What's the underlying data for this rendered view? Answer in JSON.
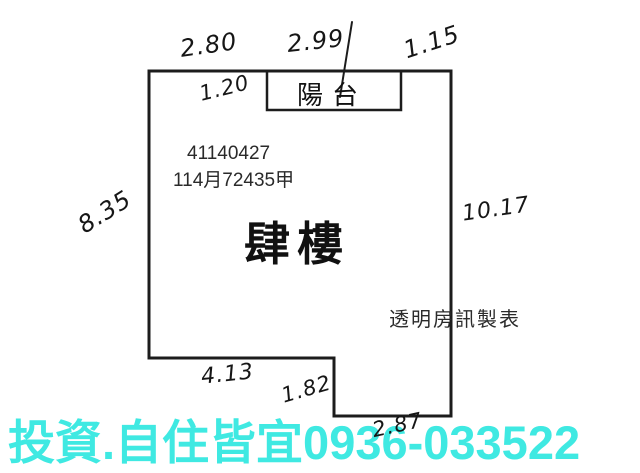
{
  "colors": {
    "background": "#ffffff",
    "outline": "#1c1c1c",
    "printed_text": "#2a2a2a",
    "handwriting": "#161616",
    "banner_text": "#3fe9e2"
  },
  "floorplan": {
    "balcony_label": "陽台",
    "serial_number": "41140427",
    "registration_number": "114月72435甲",
    "floor_label": "肆樓",
    "maker_credit": "透明房訊製表",
    "measurements": {
      "top_left": "2.80",
      "top_center": "2.99",
      "top_right": "1.15",
      "balcony_depth": "1.20",
      "left_side": "8.35",
      "right_side": "10.17",
      "bottom_left": "4.13",
      "bottom_step": "1.82",
      "bottom_right": "2.87"
    }
  },
  "banner": {
    "text": "投資.自住皆宜0936-033522"
  }
}
